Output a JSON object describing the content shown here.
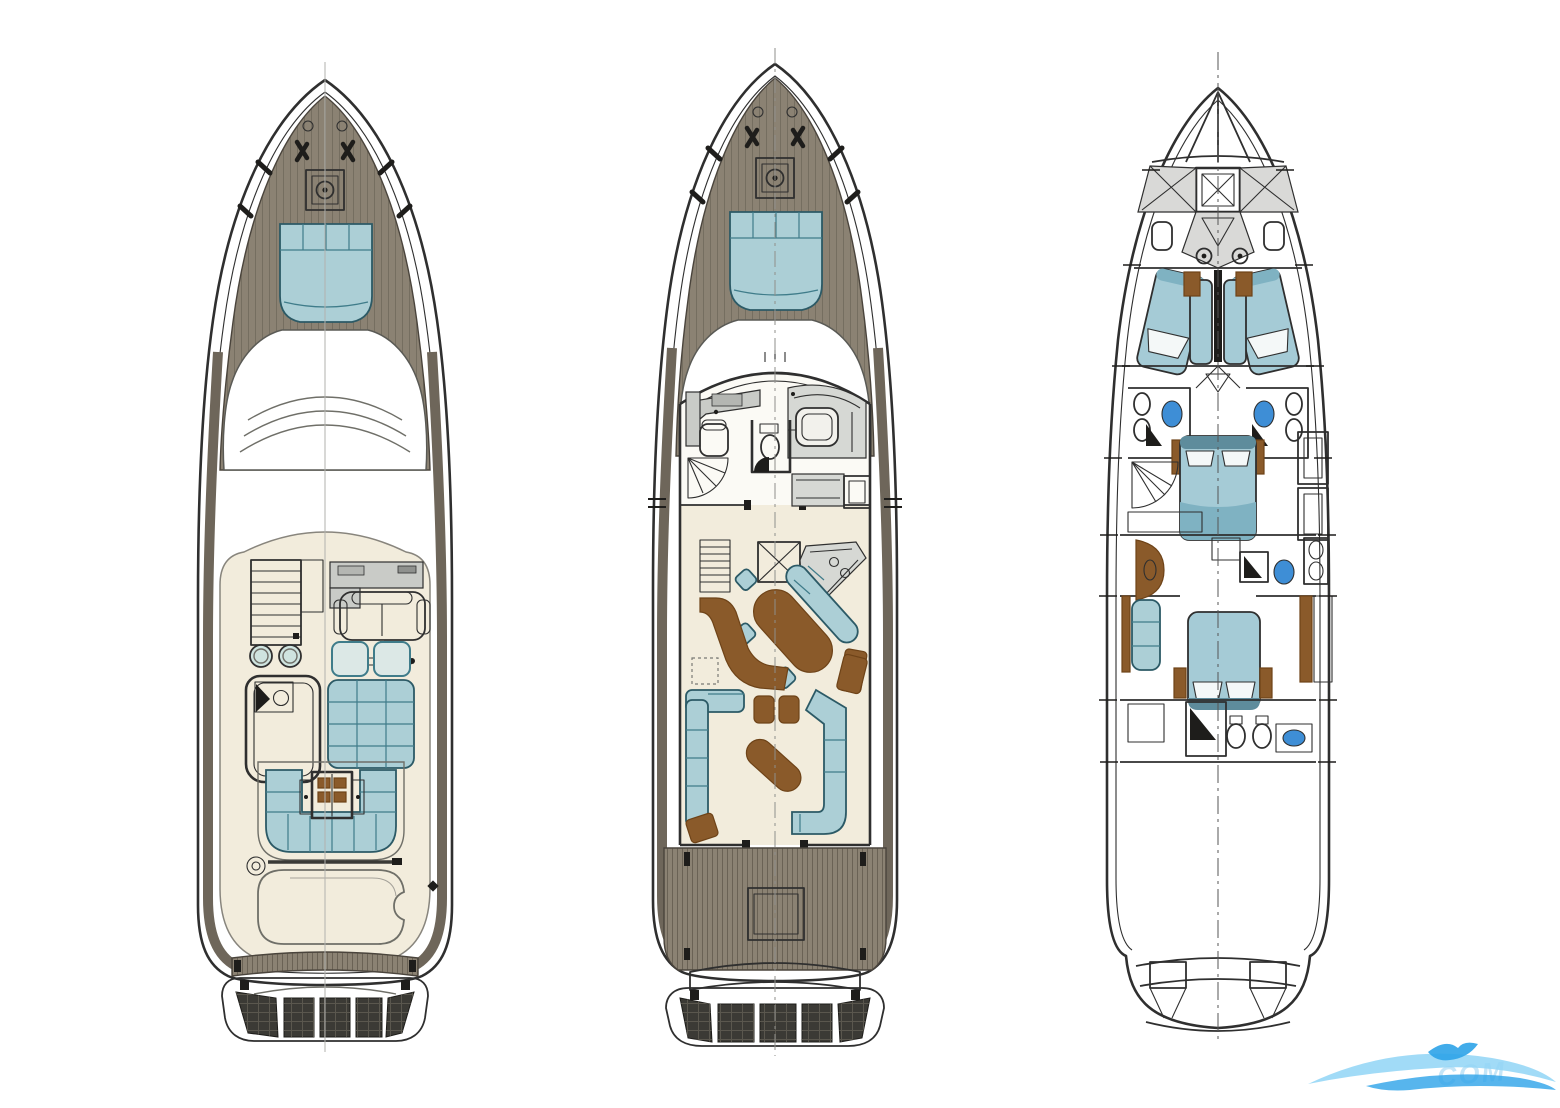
{
  "figure": {
    "type": "yacht-deck-plans",
    "views": [
      "flybridge-deck-plan",
      "main-deck-plan",
      "lower-deck-plan"
    ]
  },
  "watermark": {
    "text": "COM"
  },
  "colors": {
    "line": "#2f2f2f",
    "line_soft": "#6f6f68",
    "hull": "#ffffff",
    "teak": "#8b8273",
    "teak_dark": "#6e665a",
    "plank": "#4e463c",
    "deck_floor": "#f2ecdc",
    "cabin_floor": "#fbfaf5",
    "sunpad": "#accfd6",
    "sunpad_line": "#3f7c8a",
    "cushion": "#cfe4df",
    "console": "#c9cbc7",
    "galley": "#d6d8d4",
    "island": "#f2f1ec",
    "wood": "#8a5a2a",
    "wood_dark": "#6e4318",
    "grating": "#3b3a35",
    "grate_line": "#5a574e",
    "fixture_blue": "#3e8ed6",
    "bed": "#a5cbd6",
    "bed_dark": "#7fb2c2",
    "bed_head": "#5e8c9c",
    "pillow": "#f4f8f8",
    "gray_room": "#d9d9d7",
    "wm1": "#90d5f6",
    "wm2": "#2da3e8",
    "wm_text": "#9fd4f2",
    "page_bg": "#ffffff"
  }
}
